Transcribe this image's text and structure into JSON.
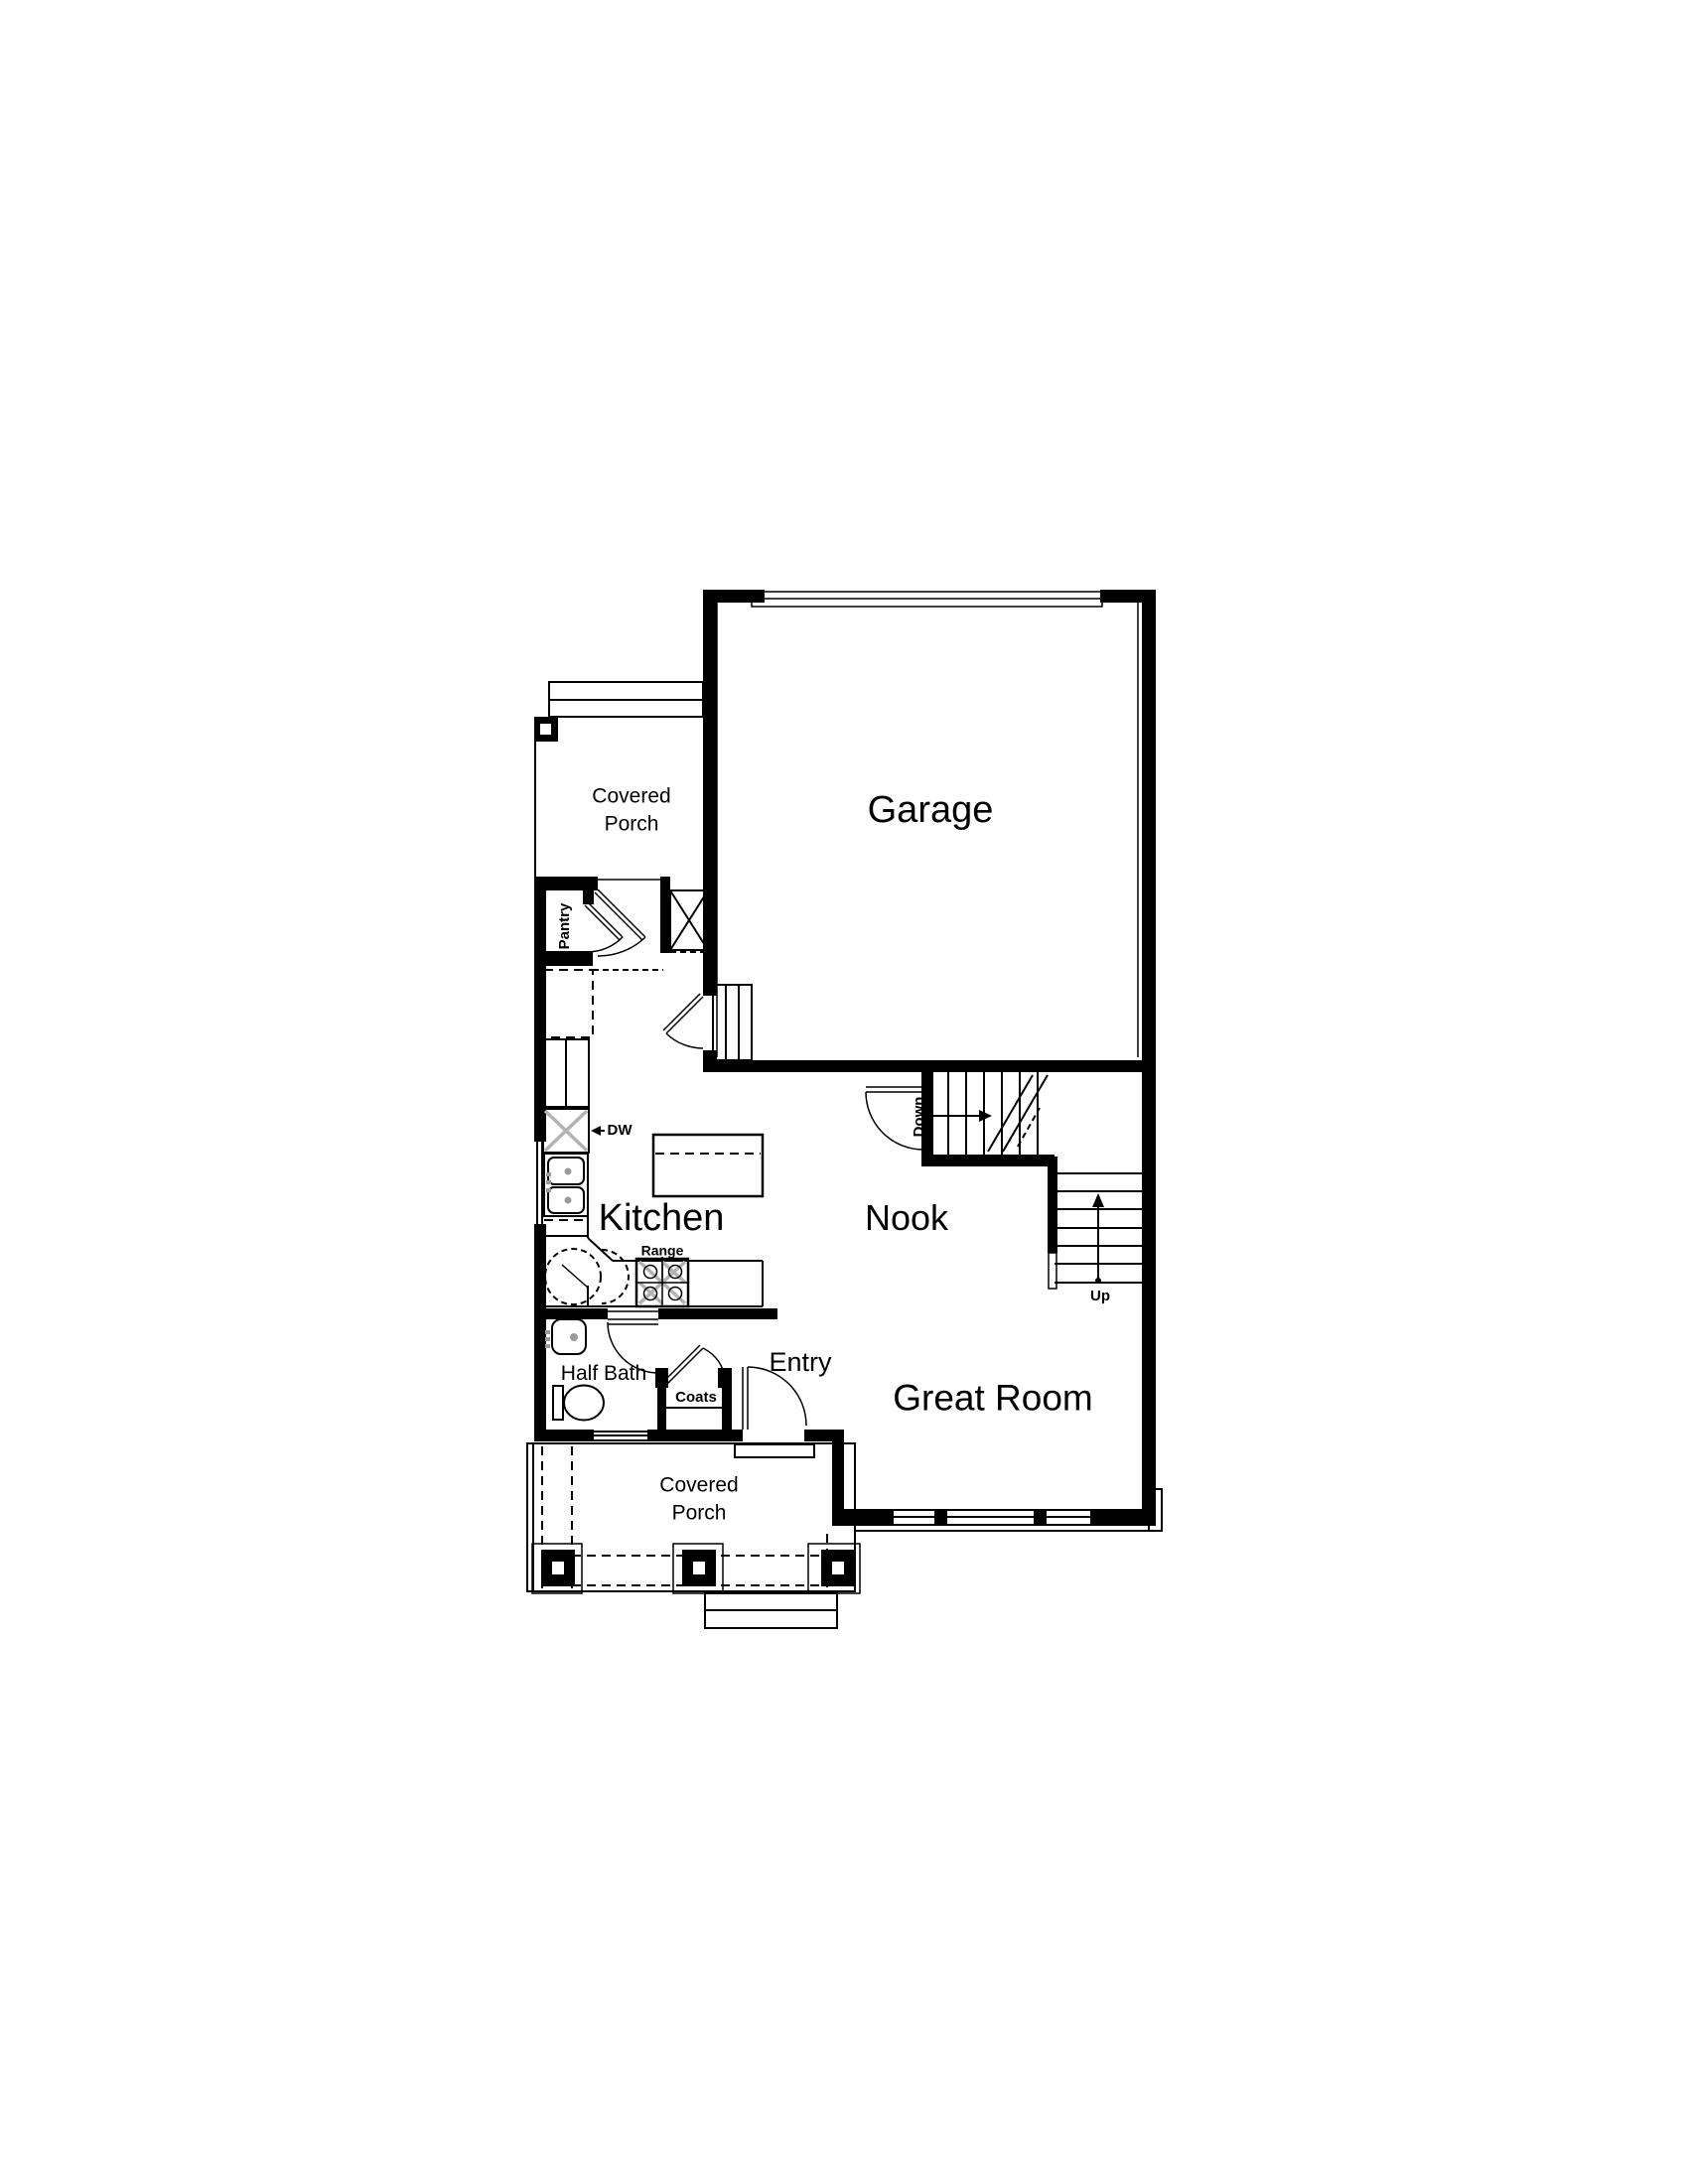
{
  "colors": {
    "line": "#000000",
    "background": "#ffffff",
    "hatch-gray": "#b3b3b3",
    "fixture-gray": "#9a9a9a"
  },
  "rooms": {
    "garage": {
      "label": "Garage"
    },
    "kitchen": {
      "label": "Kitchen"
    },
    "nook": {
      "label": "Nook"
    },
    "great_room": {
      "label": "Great Room"
    },
    "entry": {
      "label": "Entry"
    },
    "half_bath": {
      "label": "Half Bath"
    },
    "pantry": {
      "label": "Pantry"
    },
    "coats_closet": {
      "label": "Coats"
    },
    "covered_porch_top": {
      "line1": "Covered",
      "line2": "Porch"
    },
    "covered_porch_bottom": {
      "line1": "Covered",
      "line2": "Porch"
    }
  },
  "annotations": {
    "stairs_down": {
      "label": "Down"
    },
    "stairs_up": {
      "label": "Up"
    },
    "dishwasher": {
      "label": "DW"
    },
    "range": {
      "label": "Range"
    }
  }
}
